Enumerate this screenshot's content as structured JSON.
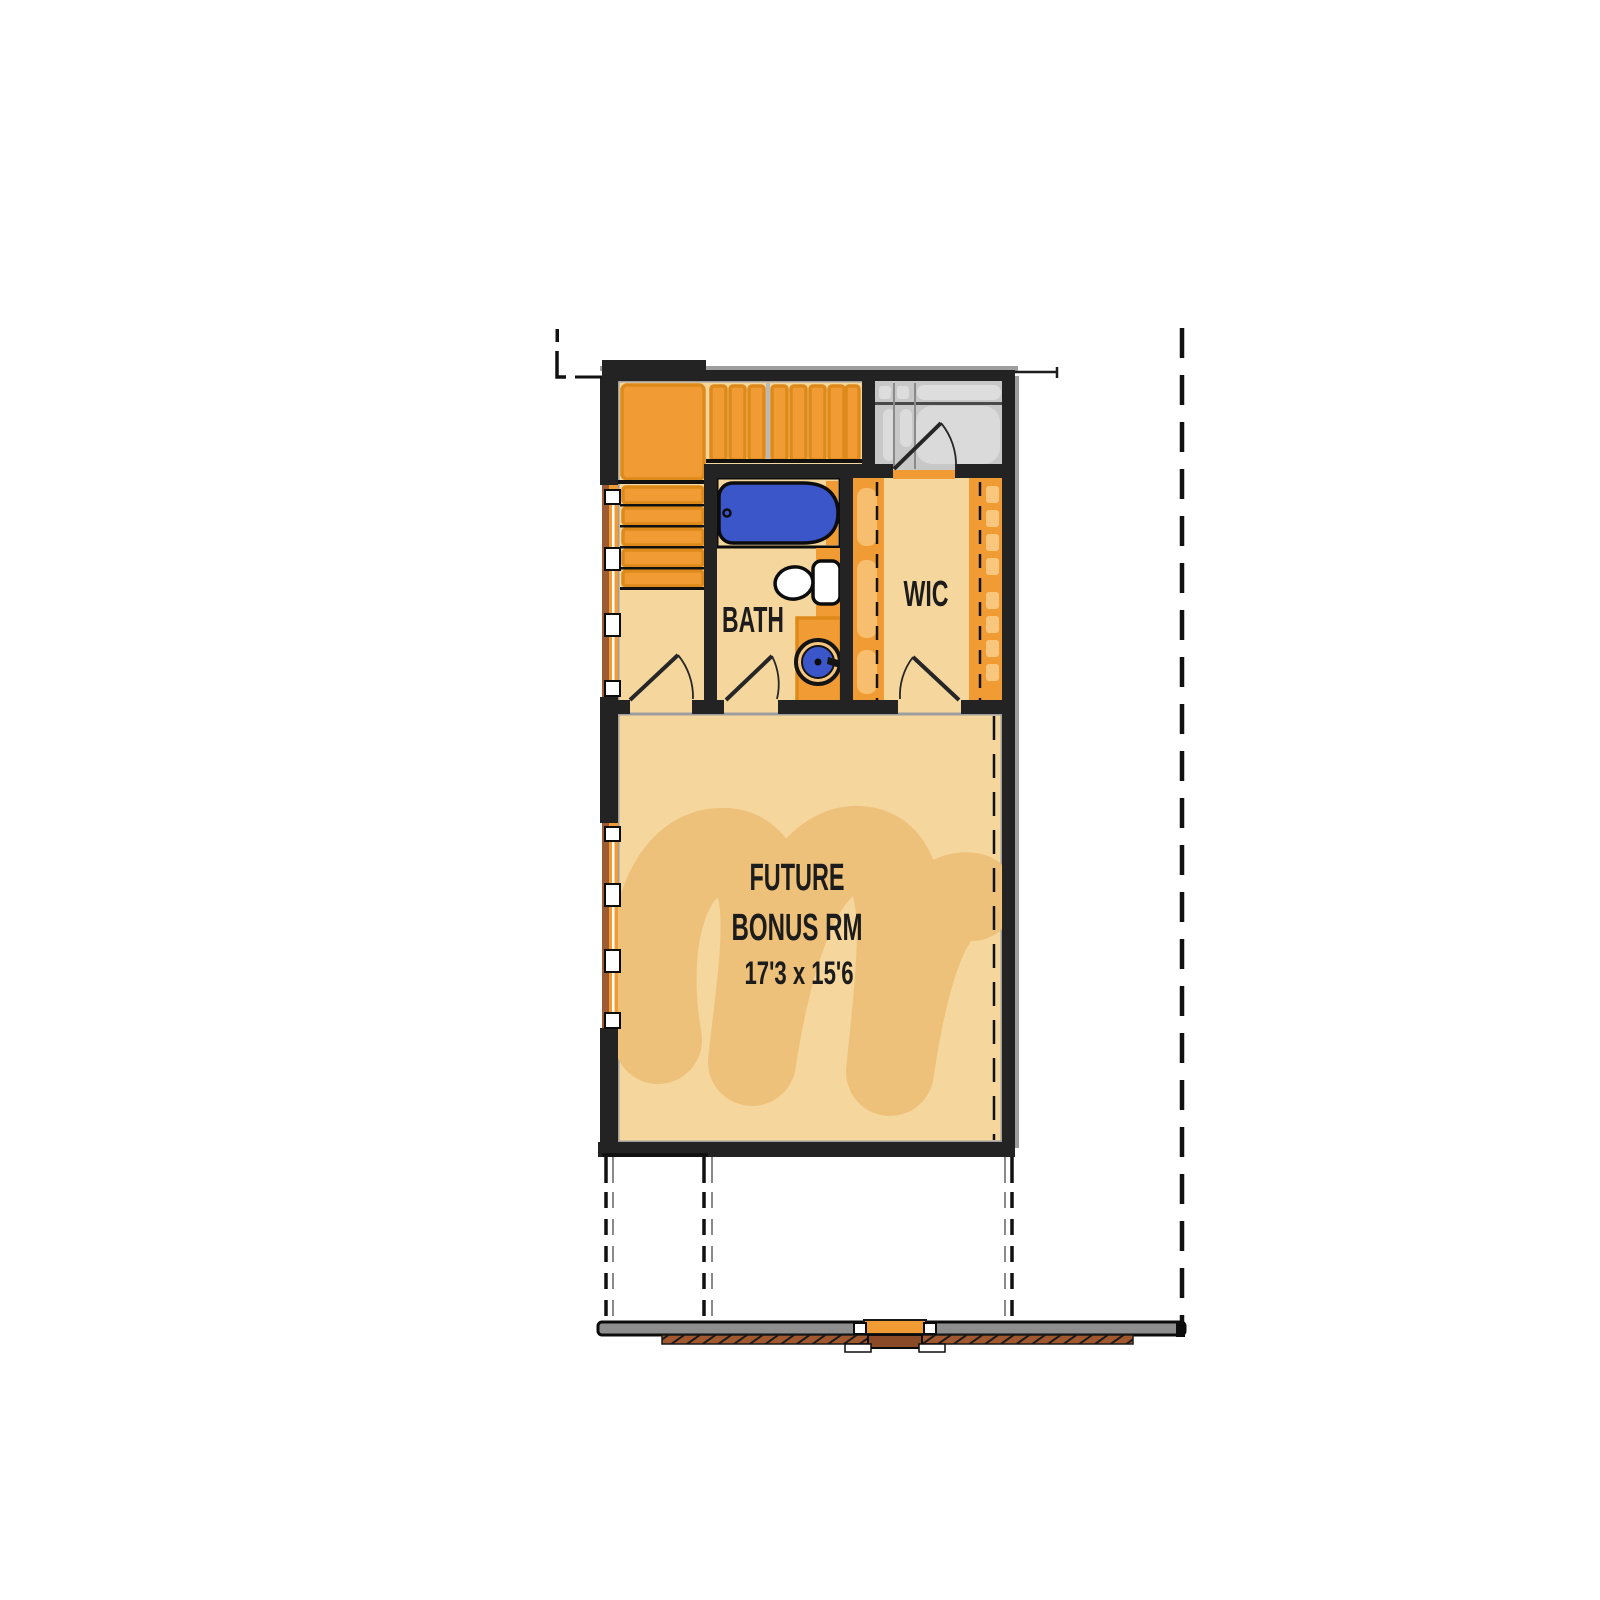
{
  "plan": {
    "type": "floor-plan",
    "labels": {
      "bonus_line1": "FUTURE",
      "bonus_line2": "BONUS RM",
      "bonus_dims": "17'3 x 15'6",
      "bath": "BATH",
      "wic": "WIC"
    },
    "fixture_names": [
      "bathtub",
      "toilet",
      "vanity-sink",
      "stair-upper-flight",
      "stair-lower-flight",
      "closet-rod-left",
      "closet-rod-right",
      "attic-storage-room",
      "window-band-upper",
      "window-band-lower",
      "door-swing"
    ],
    "colors": {
      "page": "#ffffff",
      "wall": "#232323",
      "inner_line": "#9e9e9e",
      "floor": "#f5d69d",
      "watermark": "#eec17b",
      "orange": "#f09b33",
      "orange_border": "#dd8a1b",
      "orange_light": "#f8c77d",
      "gray_room": "#c8c8c8",
      "gray_fixture": "#dddddd",
      "gray_divider": "#4a4a4a",
      "tub": "#3a56c9",
      "brown": "#9c5b33",
      "brick": "#a2582f",
      "door_brown": "#8a4a28",
      "bar_fill": "#8e8e8e",
      "line": "#262626",
      "label": "#1c1c1c"
    }
  }
}
